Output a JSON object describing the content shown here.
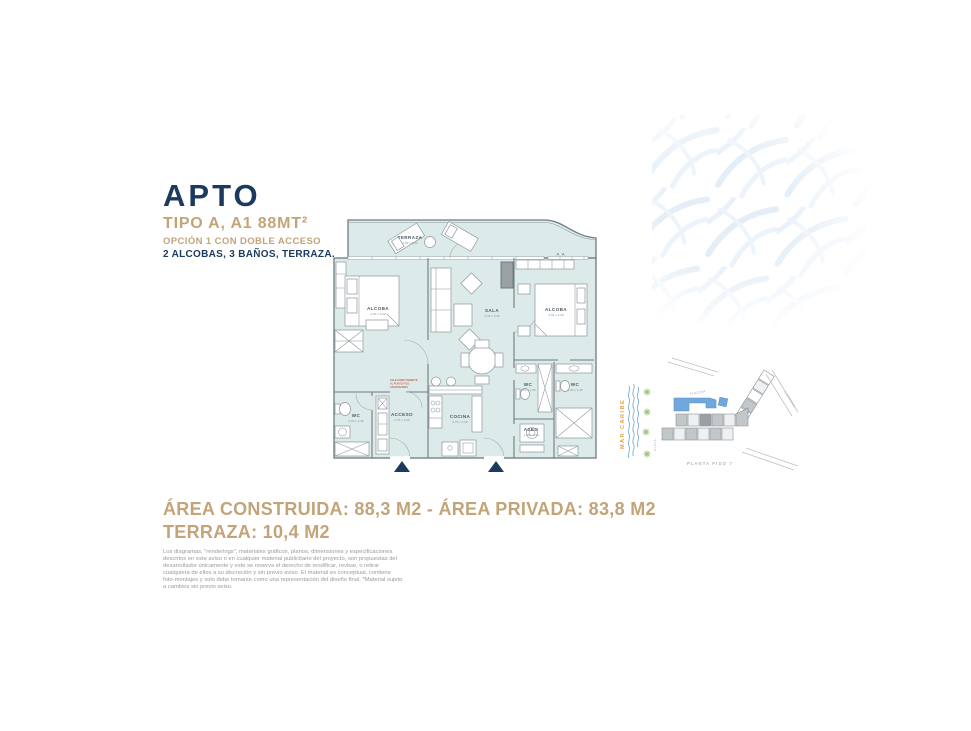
{
  "header": {
    "title": "APTO",
    "subtitle": "TIPO A, A1 88MT²",
    "option": "OPCIÓN 1 CON DOBLE ACCESO",
    "features": "2 ALCOBAS, 3 BAÑOS, TERRAZA."
  },
  "plan": {
    "rooms": [
      {
        "name": "TERRAZA",
        "dims": "1,90 x 6,90"
      },
      {
        "name": "ALCOBA",
        "dims": "4,45 x 3,00"
      },
      {
        "name": "SALA",
        "dims": "4,45 x 3,40"
      },
      {
        "name": "ALCOBA",
        "dims": "3,04 x 3,00"
      },
      {
        "name": "WC",
        "dims": "2,92 x 1,30"
      },
      {
        "name": "ACCESO",
        "dims": "2,75 x 1,59"
      },
      {
        "name": "COCINA",
        "dims": "2,75 x 3,40"
      },
      {
        "name": "WC",
        "dims": "1,83 x 1,50"
      },
      {
        "name": "WC",
        "dims": "3,40 x 1,35"
      },
      {
        "name": "ASEO",
        "dims": "1,50 x 1,38"
      }
    ],
    "section_marker": "A A",
    "access_note_lines": [
      "SALE DIRECTAMENTE",
      "AL PUNTO FIJO",
      "ASCENSORES"
    ]
  },
  "siteplan": {
    "sea_label": "MAR CARIBE",
    "beach_label": "PLAYA",
    "pool_label": "PISCINA",
    "road_label": "CARRERA",
    "floor_label": "PLANTA PISO 7"
  },
  "areas": {
    "line1": "ÁREA CONSTRUIDA: 88,3 M2 - ÁREA PRIVADA: 83,8 M2",
    "line2": "TERRAZA: 10,4 M2"
  },
  "disclaimer": "Los diagramas, \"renderings\", materiales gráficos, planos, dimensiones y especificaciones descritos en este aviso o en cualquier material publicitario del proyecto, son propuestas del desarrollador únicamente y este se reserva el derecho de modificar, revisar, o retirar cualquiera de ellos a su discreción y sin previo aviso. El material es conceptual, contiene foto-montajes y solo debe tomarse como una representación del diseño final. *Material sujeto a cambios sin previo aviso.",
  "colors": {
    "navy": "#1c3a5e",
    "tan": "#c3a478",
    "plan_fill": "#dcebe9",
    "wall_gray": "#6e7b81",
    "sea_orange": "#e6a23c",
    "pool_blue": "#6fa8dc",
    "palm_green": "#98c27c"
  }
}
